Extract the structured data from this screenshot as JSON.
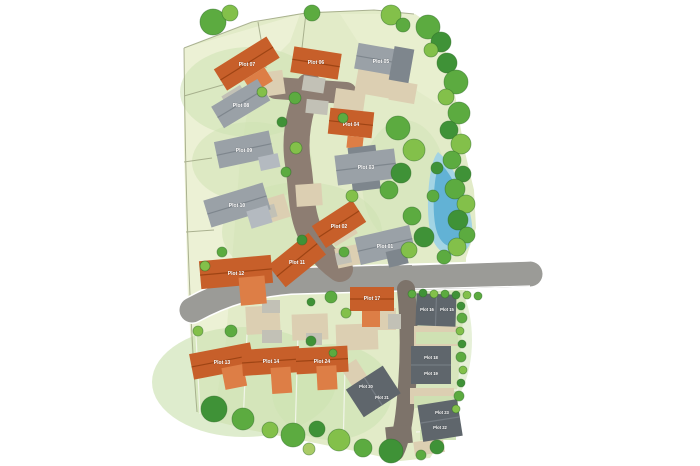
{
  "image": {
    "kind": "housing-development-site-plan",
    "background": "#ffffff"
  },
  "colors": {
    "land": "#e2ebc8",
    "land_pale": "#edf2d6",
    "garden": "#cde2b2",
    "garden_dark": "#c2daa5",
    "road_gray": "#9b9b97",
    "road_brown": "#8d7d72",
    "road_dark": "#7d736a",
    "driveway": "#dccfb2",
    "curb": "#ffffff",
    "orange_roof": "#c75f2a",
    "orange_roof_dark": "#9e4414",
    "orange_roof_light": "#dd7e46",
    "gray_roof": "#9aa1a7",
    "gray_roof_dark": "#7e868d",
    "gray_roof_light": "#b4bac0",
    "dark_roof": "#5f666c",
    "dark_roof_light": "#757c83",
    "garage": "#c2c1b6",
    "tree_dark": "#3f9237",
    "tree_mid": "#5cab40",
    "tree_light": "#83c04a",
    "tree_olive": "#a9cb66",
    "pond_outer": "#a3d4e4",
    "pond_inner": "#62b2d5",
    "label_text": "#ffffff",
    "boundary_line": "#9aa27f",
    "parcel_line_white": "#f5f7ee"
  },
  "plots": [
    {
      "label": "Plot 01",
      "roof": "gray"
    },
    {
      "label": "Plot 02",
      "roof": "orange"
    },
    {
      "label": "Plot 03",
      "roof": "gray"
    },
    {
      "label": "Plot 04",
      "roof": "orange"
    },
    {
      "label": "Plot 05",
      "roof": "gray"
    },
    {
      "label": "Plot 06",
      "roof": "orange"
    },
    {
      "label": "Plot 07",
      "roof": "orange"
    },
    {
      "label": "Plot 08",
      "roof": "gray"
    },
    {
      "label": "Plot 09",
      "roof": "gray"
    },
    {
      "label": "Plot 10",
      "roof": "gray"
    },
    {
      "label": "Plot 11",
      "roof": "orange"
    },
    {
      "label": "Plot 12",
      "roof": "orange"
    },
    {
      "label": "Plot 13",
      "roof": "orange"
    },
    {
      "label": "Plot 14",
      "roof": "orange"
    },
    {
      "label": "Plot 15",
      "roof": "dark-gray"
    },
    {
      "label": "Plot 16",
      "roof": "dark-gray"
    },
    {
      "label": "Plot 17",
      "roof": "orange"
    },
    {
      "label": "Plot 18",
      "roof": "dark-gray"
    },
    {
      "label": "Plot 19",
      "roof": "dark-gray"
    },
    {
      "label": "Plot 20",
      "roof": "dark-gray"
    },
    {
      "label": "Plot 21",
      "roof": "dark-gray"
    },
    {
      "label": "Plot 22",
      "roof": "dark-gray"
    },
    {
      "label": "Plot 23",
      "roof": "dark-gray"
    },
    {
      "label": "Plot 24",
      "roof": "orange"
    }
  ],
  "features": {
    "pond": "pond",
    "trees": "tree-canopy",
    "roads": [
      "estate-spine-road",
      "access-road",
      "rear-lane"
    ]
  }
}
